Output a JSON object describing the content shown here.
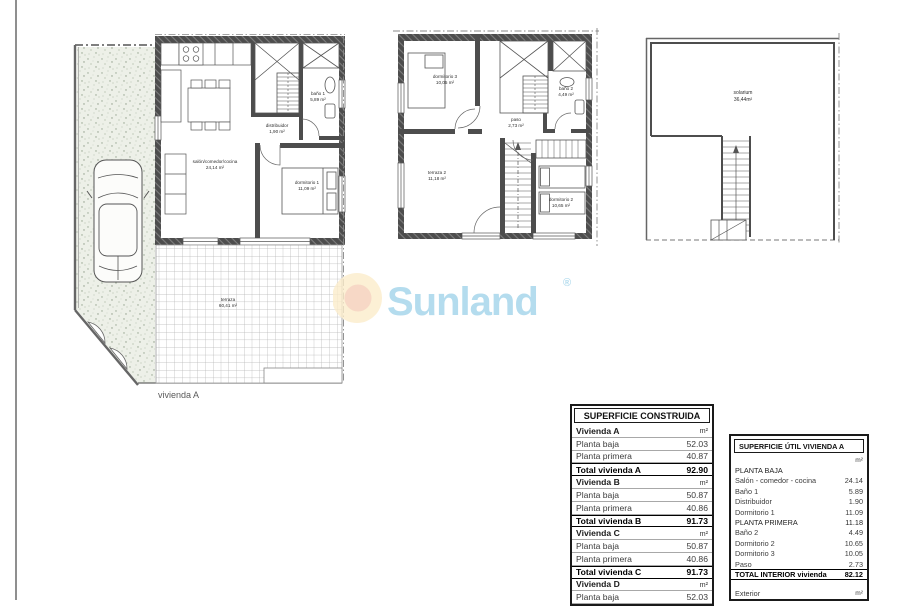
{
  "watermark": {
    "brand": "Sunland",
    "registered": "®",
    "text_color": "#b4dcee",
    "sun_outer_color": "#fbeccb",
    "sun_inner_color": "#f6d3c3"
  },
  "plans": {
    "ground_floor": {
      "title": "vivienda A",
      "rooms": {
        "living": {
          "label": "salón/comedor/cocina",
          "area": "24,14 m²"
        },
        "hall": {
          "label": "distribuidor",
          "area": "1,90 m²"
        },
        "bath1": {
          "label": "baño 1",
          "area": "5,89 m²"
        },
        "bedroom1": {
          "label": "dormitorio 1",
          "area": "11,09 m²"
        },
        "terrace": {
          "label": "terraza",
          "area": "60,41 m²"
        }
      }
    },
    "first_floor": {
      "rooms": {
        "bedroom3": {
          "label": "dormitorio 3",
          "area": "10,05 m²"
        },
        "bath2": {
          "label": "baño 2",
          "area": "4,49 m²"
        },
        "landing": {
          "label": "paso",
          "area": "2,73 m²"
        },
        "terrace2": {
          "label": "terraza 2",
          "area": "11,18 m²"
        },
        "bedroom2": {
          "label": "dormitorio 2",
          "area": "10,65 m²"
        }
      }
    },
    "solarium_floor": {
      "rooms": {
        "solarium": {
          "label": "solarium",
          "area": "36,44m²"
        }
      }
    }
  },
  "tables": {
    "construida": {
      "title": "SUPERFICIE CONSTRUIDA",
      "rows": [
        {
          "label": "Vivienda A",
          "value": "m²",
          "type": "section"
        },
        {
          "label": "Planta baja",
          "value": "52.03"
        },
        {
          "label": "Planta primera",
          "value": "40.87"
        },
        {
          "label": "Total vivienda A",
          "value": "92.90",
          "type": "total"
        },
        {
          "label": "Vivienda B",
          "value": "m²",
          "type": "section"
        },
        {
          "label": "Planta baja",
          "value": "50.87"
        },
        {
          "label": "Planta primera",
          "value": "40.86"
        },
        {
          "label": "Total vivienda B",
          "value": "91.73",
          "type": "total"
        },
        {
          "label": "Vivienda C",
          "value": "m²",
          "type": "section"
        },
        {
          "label": "Planta baja",
          "value": "50.87"
        },
        {
          "label": "Planta primera",
          "value": "40.86"
        },
        {
          "label": "Total vivienda C",
          "value": "91.73",
          "type": "total"
        },
        {
          "label": "Vivienda D",
          "value": "m²",
          "type": "section"
        },
        {
          "label": "Planta baja",
          "value": "52.03"
        }
      ]
    },
    "util_vivienda_a": {
      "title": "SUPERFICIE ÚTIL VIVIENDA A",
      "rows": [
        {
          "label": "",
          "value": "m²",
          "type": "unit"
        },
        {
          "label": "PLANTA BAJA",
          "value": "",
          "type": "section"
        },
        {
          "label": "Salón - comedor - cocina",
          "value": "24.14"
        },
        {
          "label": "Baño 1",
          "value": "5.89"
        },
        {
          "label": "Distribuidor",
          "value": "1.90"
        },
        {
          "label": "Dormitorio 1",
          "value": "11.09"
        },
        {
          "label": "PLANTA PRIMERA",
          "value": "11.18",
          "type": "section"
        },
        {
          "label": "Baño 2",
          "value": "4.49"
        },
        {
          "label": "Dormitorio 2",
          "value": "10.65"
        },
        {
          "label": "Dormitorio 3",
          "value": "10.05"
        },
        {
          "label": "Paso",
          "value": "2.73"
        },
        {
          "label": "TOTAL INTERIOR vivienda",
          "value": "82.12",
          "type": "total"
        },
        {
          "label": "",
          "value": "",
          "type": "blank"
        },
        {
          "label": "Exterior",
          "value": "m²",
          "type": "unit"
        }
      ]
    }
  }
}
